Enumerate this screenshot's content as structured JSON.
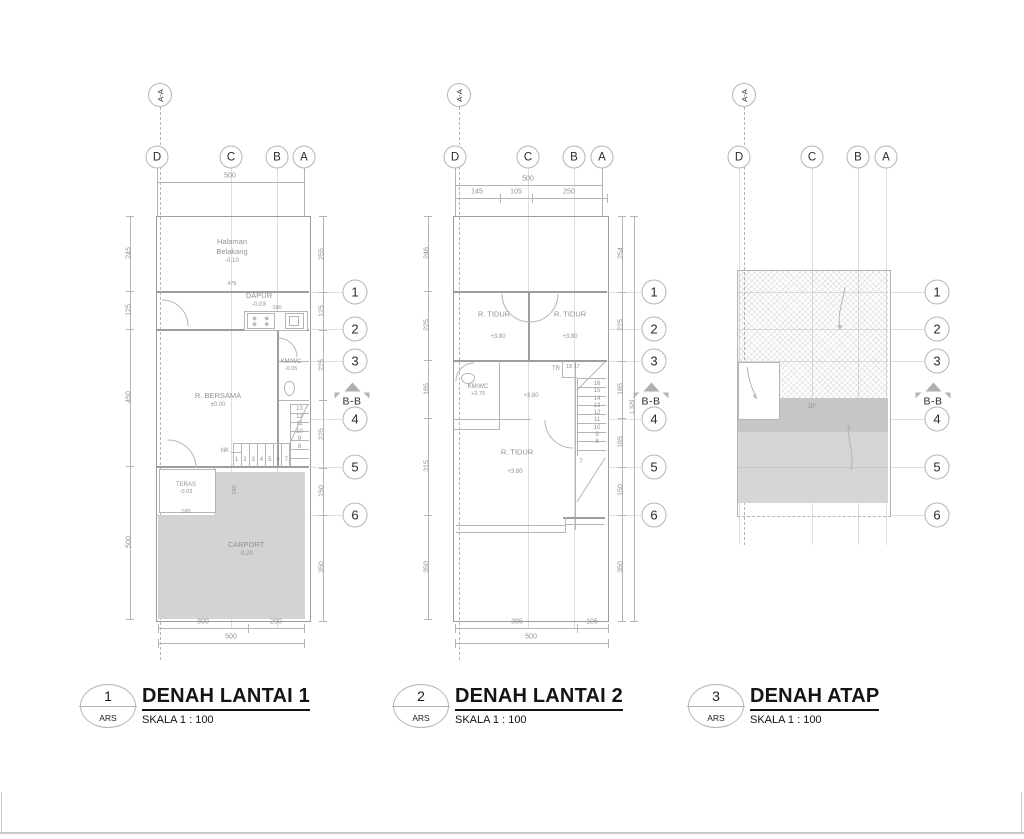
{
  "drawing": {
    "colors": {
      "line": "#b3b6b9",
      "wall": "#9a9da1",
      "tgray": "#8e9194",
      "ink": "#1c1c1c",
      "carport": "#d2d3d5",
      "roofdark": "#c5c6c8",
      "rooflight": "#d5d6d8",
      "edge": "#c7c9cb"
    }
  },
  "grid": {
    "cols": [
      "D",
      "C",
      "B",
      "A"
    ],
    "rows": [
      "1",
      "2",
      "3",
      "4",
      "5",
      "6"
    ]
  },
  "sections": {
    "aa": "A-A",
    "bb": "B-B"
  },
  "plan1": {
    "callout": {
      "num": "1",
      "dept": "ARS"
    },
    "title": "DENAH LANTAI 1",
    "scale": "SKALA 1 : 100",
    "dims": {
      "top_total": "500",
      "top_inner": "476",
      "left": [
        "245",
        "125",
        "450",
        "500"
      ],
      "right": [
        "255",
        "125",
        "225",
        "225",
        "150",
        "350"
      ],
      "bottom": [
        "300",
        "200"
      ],
      "bottom_total": "500",
      "kitchen": "180",
      "teras_w": "180",
      "teras_h": "150"
    },
    "rooms": {
      "halaman": {
        "line1": "Halaman",
        "line2": "Belakang",
        "level": "-0.10"
      },
      "dapur": {
        "name": "DAPUR",
        "level": "-0.03"
      },
      "kmwc": {
        "name": "KM/WC",
        "level": "-0.05"
      },
      "bersama": {
        "name": "R. BERSAMA",
        "level": "±0.00"
      },
      "teras": {
        "name": "TERAS",
        "level": "-0.03"
      },
      "carport": {
        "name": "CARPORT",
        "level": "-0.20"
      }
    },
    "stairs": {
      "label": "NK",
      "run": [
        "1",
        "2",
        "3",
        "4",
        "5",
        "6",
        "7"
      ],
      "rise": [
        "13",
        "12",
        "11",
        "10",
        "9",
        "8"
      ]
    }
  },
  "plan2": {
    "callout": {
      "num": "2",
      "dept": "ARS"
    },
    "title": "DENAH LANTAI 2",
    "scale": "SKALA 1 : 100",
    "dims": {
      "top_total": "500",
      "top_sub": [
        "145",
        "105",
        "250"
      ],
      "left": [
        "246",
        "225",
        "185",
        "315",
        "350"
      ],
      "right": [
        "254",
        "225",
        "185",
        "185",
        "150",
        "350"
      ],
      "overall": "1,329",
      "bottom": [
        "395",
        "105"
      ],
      "bottom_total": "500"
    },
    "rooms": {
      "tidur_l": {
        "name": "R. TIDUR",
        "level": "+3.80"
      },
      "tidur_r": {
        "name": "R. TIDUR",
        "level": "+3.80"
      },
      "kmwc": {
        "name": "KM/WC",
        "level": "+3.75"
      },
      "hall": {
        "level": "+3.80"
      },
      "tidur_b": {
        "name": "R. TIDUR",
        "level": "+3.80"
      }
    },
    "stairs": {
      "label": "TR",
      "top": [
        "18",
        "17"
      ],
      "rise": [
        "16",
        "15",
        "14",
        "13",
        "12",
        "11",
        "10",
        "9",
        "8"
      ],
      "start": "7"
    }
  },
  "plan3": {
    "callout": {
      "num": "3",
      "dept": "ARS"
    },
    "title": "DENAH ATAP",
    "scale": "SKALA 1 : 100",
    "roof": {
      "slope": "10°"
    }
  }
}
